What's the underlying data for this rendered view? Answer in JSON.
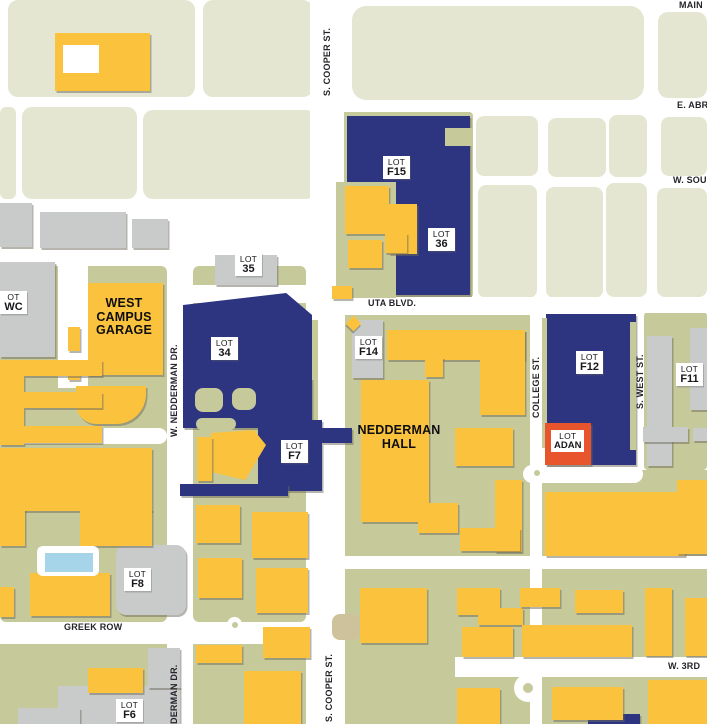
{
  "title": "UTA campus parking map",
  "colors": {
    "road": "#FFFFFF",
    "city_block": "#E5E6D1",
    "campus_ground": "#C6CA9B",
    "tan_patch": "#CDC29C",
    "gray_building": "#C9CBCB",
    "parking_lot": "#2D3480",
    "campus_building": "#FBC33D",
    "pool": "#A6D4E8",
    "highlight": "#E8542C",
    "label_bg": "#FFFFFF",
    "text": "#1A191E"
  },
  "lots": [
    {
      "id": "f15",
      "x": 383,
      "y": 156,
      "l1": "LOT",
      "l2": "F15"
    },
    {
      "id": "36",
      "x": 428,
      "y": 228,
      "l1": "LOT",
      "l2": "36"
    },
    {
      "id": "35",
      "x": 235,
      "y": 253,
      "l1": "LOT",
      "l2": "35"
    },
    {
      "id": "34",
      "x": 211,
      "y": 337,
      "l1": "LOT",
      "l2": "34"
    },
    {
      "id": "f14",
      "x": 355,
      "y": 336,
      "l1": "LOT",
      "l2": "F14"
    },
    {
      "id": "f7",
      "x": 281,
      "y": 440,
      "l1": "LOT",
      "l2": "F7"
    },
    {
      "id": "f12",
      "x": 576,
      "y": 351,
      "l1": "LOT",
      "l2": "F12"
    },
    {
      "id": "f11",
      "x": 676,
      "y": 363,
      "l1": "LOT",
      "l2": "F11"
    },
    {
      "id": "f8",
      "x": 124,
      "y": 568,
      "l1": "LOT",
      "l2": "F8"
    },
    {
      "id": "f6",
      "x": 116,
      "y": 699,
      "l1": "LOT",
      "l2": "F6"
    },
    {
      "id": "wc",
      "x": 0,
      "y": 291,
      "l1": "OT",
      "l2": "WC"
    }
  ],
  "highlight_lot": {
    "id": "adan",
    "box": [
      545,
      423,
      46,
      42
    ],
    "label": [
      551,
      430,
      34,
      28
    ],
    "l1": "LOT",
    "l2": "ADAN"
  },
  "places": [
    {
      "id": "west-campus-garage",
      "x": 86,
      "y": 297,
      "w": 76,
      "lines": [
        "WEST",
        "CAMPUS",
        "GARAGE"
      ]
    },
    {
      "id": "nedderman-hall",
      "x": 349,
      "y": 424,
      "w": 100,
      "lines": [
        "NEDDERMAN",
        "HALL"
      ]
    }
  ],
  "streets": [
    {
      "id": "main-st",
      "x": 679,
      "y": 0,
      "dir": "h",
      "text": "MAIN"
    },
    {
      "id": "e-abram-st",
      "x": 677,
      "y": 100,
      "dir": "h",
      "text": "E. ABR"
    },
    {
      "id": "w-south-st",
      "x": 673,
      "y": 175,
      "dir": "h",
      "text": "W. SOU"
    },
    {
      "id": "uta-blvd",
      "x": 368,
      "y": 298,
      "dir": "h",
      "text": "UTA BLVD."
    },
    {
      "id": "greek-row",
      "x": 64,
      "y": 622,
      "dir": "h",
      "text": "GREEK ROW"
    },
    {
      "id": "w-3rd-st",
      "x": 668,
      "y": 661,
      "dir": "h",
      "text": "W. 3RD"
    },
    {
      "id": "s-cooper-st-north",
      "x": 322,
      "y": 16,
      "h": 80,
      "dir": "v",
      "text": "S. COOPER ST."
    },
    {
      "id": "s-cooper-st-south",
      "x": 324,
      "y": 642,
      "h": 80,
      "dir": "v",
      "text": "S. COOPER ST."
    },
    {
      "id": "w-nedderman-dr",
      "x": 169,
      "y": 335,
      "h": 102,
      "dir": "v",
      "text": "W. NEDDERMAN DR."
    },
    {
      "id": "nedderman-dr-south",
      "x": 169,
      "y": 656,
      "h": 68,
      "dir": "v",
      "text": "DERMAN DR."
    },
    {
      "id": "college-st",
      "x": 531,
      "y": 350,
      "h": 68,
      "dir": "v",
      "text": "COLLEGE ST."
    },
    {
      "id": "s-west-st",
      "x": 635,
      "y": 347,
      "h": 62,
      "dir": "v",
      "text": "S. WEST ST."
    }
  ],
  "regions": [
    [
      "block",
      8,
      0,
      187,
      97,
      {
        "r": 10
      }
    ],
    [
      "block",
      203,
      0,
      110,
      97,
      {
        "r": 10
      }
    ],
    [
      "block",
      352,
      6,
      292,
      94,
      {
        "r": 14
      }
    ],
    [
      "block",
      658,
      12,
      49,
      86,
      {
        "r": 10
      }
    ],
    [
      "block",
      0,
      107,
      16,
      92,
      {
        "r": 6
      }
    ],
    [
      "block",
      22,
      107,
      115,
      92,
      {
        "r": 10
      }
    ],
    [
      "block",
      143,
      110,
      173,
      89,
      {
        "r": 10
      }
    ],
    [
      "block",
      476,
      116,
      62,
      60,
      {
        "r": 8
      }
    ],
    [
      "block",
      548,
      118,
      58,
      59,
      {
        "r": 8
      }
    ],
    [
      "block",
      609,
      115,
      38,
      62,
      {
        "r": 8
      }
    ],
    [
      "block",
      661,
      117,
      46,
      59,
      {
        "r": 8
      }
    ],
    [
      "block",
      478,
      185,
      59,
      113,
      {
        "r": 8
      }
    ],
    [
      "block",
      546,
      187,
      57,
      111,
      {
        "r": 8
      }
    ],
    [
      "block",
      606,
      183,
      41,
      114,
      {
        "r": 8
      }
    ],
    [
      "block",
      657,
      188,
      50,
      109,
      {
        "r": 8
      }
    ],
    [
      "olive",
      336,
      112,
      137,
      186,
      {
        "r": 4,
        "n": "lot-f15-block"
      }
    ],
    [
      "olive",
      0,
      266,
      167,
      356,
      {
        "r": 6
      }
    ],
    [
      "olive",
      193,
      266,
      113,
      356,
      {
        "r": 6
      }
    ],
    [
      "olive",
      0,
      644,
      167,
      80
    ],
    [
      "olive",
      193,
      644,
      113,
      80
    ],
    [
      "olive",
      345,
      315,
      185,
      409
    ],
    [
      "olive",
      542,
      470,
      165,
      254
    ],
    [
      "olive",
      644,
      312,
      63,
      158,
      {
        "r": 4
      }
    ],
    [
      "road",
      0,
      248,
      345,
      18,
      {
        "r": 6
      }
    ],
    [
      "road",
      167,
      258,
      26,
      466,
      {
        "n": "w-nedderman-dr-road"
      }
    ],
    [
      "road",
      310,
      0,
      34,
      724,
      {
        "n": "s-cooper-st-road"
      }
    ],
    [
      "road",
      193,
      285,
      117,
      18
    ],
    [
      "road",
      345,
      297,
      362,
      16,
      {
        "n": "uta-blvd-road"
      }
    ],
    [
      "road",
      0,
      622,
      310,
      22,
      {
        "n": "greek-row-road"
      }
    ],
    [
      "road",
      455,
      657,
      252,
      20,
      {
        "n": "w-3rd-st-road"
      }
    ],
    [
      "road",
      0,
      428,
      167,
      16,
      {
        "r": 8
      }
    ],
    [
      "road",
      58,
      260,
      30,
      128
    ],
    [
      "road",
      523,
      465,
      120,
      18,
      {
        "r": 9
      }
    ],
    [
      "road",
      345,
      556,
      362,
      13
    ],
    [
      "olive",
      309,
      320,
      9,
      110,
      {
        "n": "street-median"
      }
    ],
    [
      "tan",
      332,
      614,
      28,
      26,
      {
        "r": 8
      }
    ],
    [
      "road",
      514,
      674,
      28,
      28,
      {
        "r": "50%",
        "n": "roundabout"
      }
    ],
    [
      "dot",
      523,
      683,
      10,
      10,
      {
        "r": "50%"
      }
    ],
    [
      "road",
      227,
      617,
      15,
      15,
      {
        "r": "50%",
        "n": "roundabout"
      }
    ],
    [
      "dot",
      232,
      622,
      6,
      6,
      {
        "r": "50%"
      }
    ],
    [
      "road",
      530,
      466,
      14,
      14,
      {
        "r": "50%",
        "n": "roundabout"
      }
    ],
    [
      "dot",
      534,
      470,
      6,
      6,
      {
        "r": "50%"
      }
    ],
    [
      "gray",
      0,
      203,
      32,
      44
    ],
    [
      "gray",
      40,
      212,
      86,
      36
    ],
    [
      "gray",
      132,
      219,
      36,
      29
    ],
    [
      "gray",
      0,
      262,
      55,
      95,
      {
        "n": "wc-building"
      }
    ],
    [
      "gray",
      215,
      255,
      62,
      30,
      {
        "n": "lot-35-area"
      }
    ],
    [
      "gray",
      352,
      320,
      31,
      58,
      {
        "n": "lot-f14-area"
      }
    ],
    [
      "gray",
      116,
      545,
      70,
      70,
      {
        "r": 10,
        "n": "lot-f8-area"
      }
    ],
    [
      "gray",
      58,
      686,
      122,
      38,
      {
        "n": "lot-f6-area"
      }
    ],
    [
      "gray",
      148,
      648,
      32,
      40
    ],
    [
      "gray",
      18,
      708,
      62,
      16
    ],
    [
      "gray",
      647,
      336,
      25,
      130,
      {
        "n": "lot-f11-area"
      }
    ],
    [
      "gray",
      690,
      328,
      17,
      82
    ],
    [
      "gray",
      643,
      427,
      45,
      15
    ],
    [
      "gray",
      693,
      428,
      14,
      13
    ],
    [
      "blue",
      347,
      116,
      123,
      179,
      {
        "n": "lot-f15-area"
      }
    ],
    [
      "blue",
      183,
      293,
      129,
      100,
      {
        "cp": "polygon(0 12%,80% 0,100% 22%,100% 100%,0 100%)",
        "n": "lot-34-area"
      }
    ],
    [
      "blue",
      183,
      378,
      129,
      50,
      {
        "n": "lot-34-area"
      }
    ],
    [
      "blue",
      258,
      420,
      64,
      71,
      {
        "n": "lot-f7-area"
      }
    ],
    [
      "blue",
      322,
      428,
      30,
      15,
      {
        "n": "lot-f7-area"
      }
    ],
    [
      "blue",
      180,
      484,
      108,
      12
    ],
    [
      "blue",
      546,
      314,
      90,
      151,
      {
        "n": "lot-f12-area"
      }
    ],
    [
      "blue",
      588,
      714,
      52,
      10
    ],
    [
      "hole",
      336,
      182,
      60,
      116
    ],
    [
      "hole",
      445,
      128,
      28,
      18
    ],
    [
      "hole",
      195,
      388,
      28,
      24,
      {
        "r": 8
      }
    ],
    [
      "hole",
      232,
      388,
      24,
      22,
      {
        "r": 8
      }
    ],
    [
      "hole",
      196,
      418,
      40,
      12,
      {
        "r": 6
      }
    ],
    [
      "hole",
      542,
      318,
      5,
      130
    ],
    [
      "hole",
      630,
      322,
      6,
      128
    ],
    [
      "yellow",
      55,
      33,
      95,
      58,
      {
        "n": "city-building"
      }
    ],
    [
      "road",
      63,
      45,
      36,
      28,
      {
        "n": "courtyard"
      }
    ],
    [
      "yellow",
      345,
      186,
      44,
      48
    ],
    [
      "yellow",
      389,
      204,
      28,
      50
    ],
    [
      "yellow",
      348,
      240,
      34,
      28
    ],
    [
      "yellow",
      385,
      233,
      22,
      20
    ],
    [
      "yellow",
      332,
      286,
      20,
      13
    ],
    [
      "yellow",
      88,
      283,
      75,
      92,
      {
        "n": "west-campus-garage-building"
      }
    ],
    [
      "yellow",
      76,
      386,
      70,
      38,
      {
        "r": "0 0 30px 20px"
      }
    ],
    [
      "yellow",
      68,
      327,
      12,
      24
    ],
    [
      "yellow",
      68,
      362,
      12,
      18
    ],
    [
      "yellow",
      0,
      360,
      24,
      85
    ],
    [
      "yellow",
      24,
      360,
      78,
      16
    ],
    [
      "yellow",
      24,
      392,
      78,
      16
    ],
    [
      "yellow",
      24,
      426,
      78,
      17
    ],
    [
      "yellow",
      0,
      448,
      152,
      63
    ],
    [
      "yellow",
      80,
      509,
      72,
      37
    ],
    [
      "yellow",
      0,
      509,
      25,
      37
    ],
    [
      "yellow",
      30,
      573,
      80,
      43
    ],
    [
      "yellow",
      88,
      668,
      55,
      25
    ],
    [
      "yellow",
      196,
      645,
      46,
      18
    ],
    [
      "yellow",
      244,
      671,
      57,
      53
    ],
    [
      "yellow",
      263,
      627,
      47,
      31
    ],
    [
      "yellow",
      196,
      505,
      44,
      38
    ],
    [
      "yellow",
      252,
      512,
      56,
      46
    ],
    [
      "yellow",
      198,
      558,
      44,
      40
    ],
    [
      "yellow",
      256,
      568,
      52,
      45
    ],
    [
      "yellow",
      387,
      330,
      138,
      30
    ],
    [
      "yellow",
      480,
      330,
      45,
      85
    ],
    [
      "yellow",
      425,
      357,
      18,
      20
    ],
    [
      "yellow",
      361,
      380,
      68,
      142,
      {
        "n": "nedderman-hall-building"
      }
    ],
    [
      "yellow",
      455,
      428,
      58,
      38
    ],
    [
      "yellow",
      495,
      480,
      27,
      72
    ],
    [
      "yellow",
      460,
      528,
      60,
      23
    ],
    [
      "yellow",
      418,
      503,
      40,
      30
    ],
    [
      "yellow",
      545,
      492,
      140,
      64
    ],
    [
      "yellow",
      677,
      480,
      30,
      74
    ],
    [
      "yellow",
      360,
      588,
      67,
      55
    ],
    [
      "yellow",
      457,
      588,
      43,
      27
    ],
    [
      "yellow",
      478,
      608,
      45,
      17
    ],
    [
      "yellow",
      520,
      588,
      40,
      19
    ],
    [
      "yellow",
      575,
      590,
      48,
      23
    ],
    [
      "yellow",
      522,
      625,
      110,
      32
    ],
    [
      "yellow",
      462,
      627,
      51,
      30
    ],
    [
      "yellow",
      457,
      688,
      43,
      36
    ],
    [
      "yellow",
      552,
      687,
      71,
      33
    ],
    [
      "yellow",
      645,
      588,
      27,
      68
    ],
    [
      "yellow",
      685,
      598,
      22,
      58
    ],
    [
      "yellow",
      648,
      680,
      59,
      44
    ],
    [
      "yellow",
      0,
      587,
      14,
      30
    ],
    [
      "yellow",
      211,
      430,
      55,
      50,
      {
        "cp": "polygon(0 6%,78% 0,100% 30%,62% 100%,0 84%)"
      }
    ],
    [
      "yellow",
      197,
      437,
      15,
      44
    ],
    [
      "road",
      37,
      546,
      62,
      30,
      {
        "r": 6,
        "n": "pool-deck"
      }
    ],
    [
      "pool",
      44,
      552,
      48,
      19,
      {
        "n": "swimming-pool"
      }
    ],
    [
      "yellow",
      348,
      318,
      11,
      11,
      {
        "rot": 45,
        "n": "corner-marker"
      }
    ]
  ]
}
